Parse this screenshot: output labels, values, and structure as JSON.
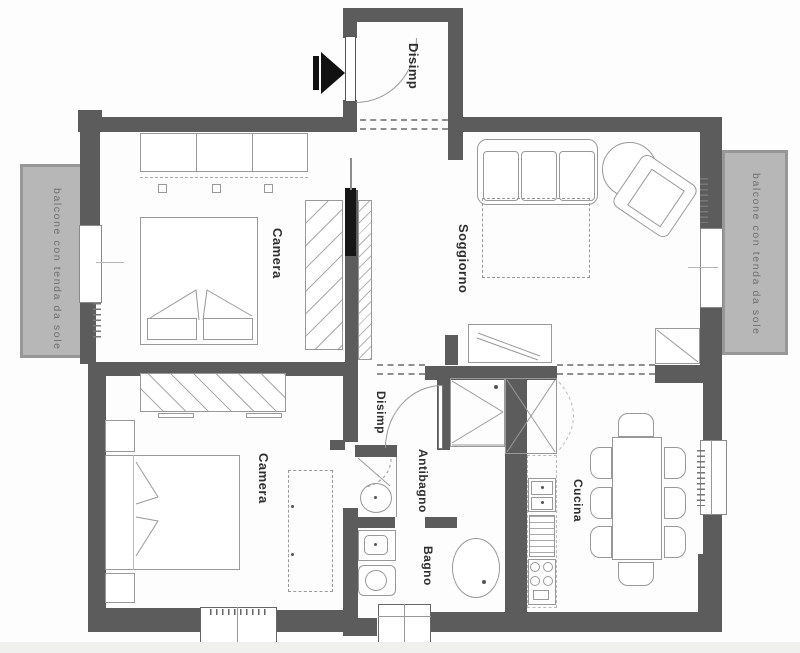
{
  "floorplan": {
    "labels": {
      "entry_hall": "Disimp",
      "bedroom_main": "Camera",
      "living_room": "Soggiorno",
      "bedroom_second": "Camera",
      "inner_hall": "Disimp",
      "antechamber": "Antibagno",
      "bathroom": "Bagno",
      "kitchen": "Cucina",
      "balcony": "balcone con tenda da sole"
    },
    "colors": {
      "wall": "#5c5c5c",
      "balcony_fill": "#b7b7b7",
      "furniture_line": "#999999",
      "label_text": "#2f2f2f",
      "balcony_text": "#6e6e6e",
      "entry_arrow": "#111111"
    }
  }
}
